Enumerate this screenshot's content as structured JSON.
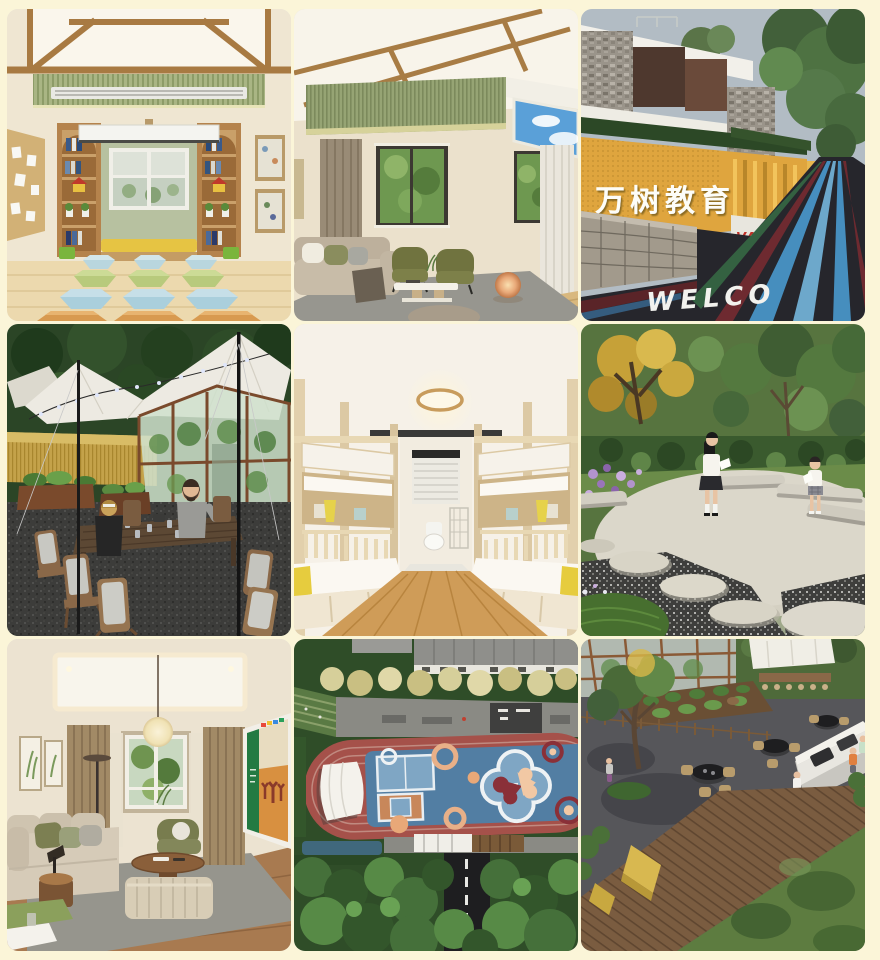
{
  "page": {
    "background": "#fbf5d8"
  },
  "gallery": {
    "tiles": [
      {
        "id": "classroom",
        "alt": "Kindergarten classroom with wood beam ceiling, bookshelves, window bench and rows of hexagonal stools"
      },
      {
        "id": "lofted-living",
        "alt": "Double-height living room with wood beam ceiling, green slat wall, skylight, olive armchairs and glowing sphere lamp"
      },
      {
        "id": "school-entrance",
        "alt": "School entrance with yellow perforated sign wall, stone walls and welcome road graphics",
        "sign_text": "万树教育",
        "brand_text": "VANSHU",
        "road_text": "WELCO",
        "colors": {
          "sign_wall": "#dfa53e",
          "brand_red": "#c03028"
        }
      },
      {
        "id": "tent-dining",
        "alt": "Outdoor canopy tent with string lights, long wooden dining table, greenhouse and wheat field"
      },
      {
        "id": "dormitory",
        "alt": "Dormitory with light wood bunk beds on both sides, round ceiling light and window at the end"
      },
      {
        "id": "garden-circle",
        "alt": "Garden with circular concrete plaza, stone benches, stepping stones and two students reading"
      },
      {
        "id": "lounge",
        "alt": "Lounge room with paper lantern pendant, beige sofa, ottoman and green display screen"
      },
      {
        "id": "aerial-playground",
        "alt": "Aerial view of running track and blue sports court with colorful clover supergraphic",
        "colors": {
          "track_red": "#a5514a",
          "court_blue": "#527ea3"
        }
      },
      {
        "id": "aerial-bbq",
        "alt": "Aerial view of BBQ terrace with round grill tables, white counter, wooden deck and lawn"
      }
    ]
  }
}
